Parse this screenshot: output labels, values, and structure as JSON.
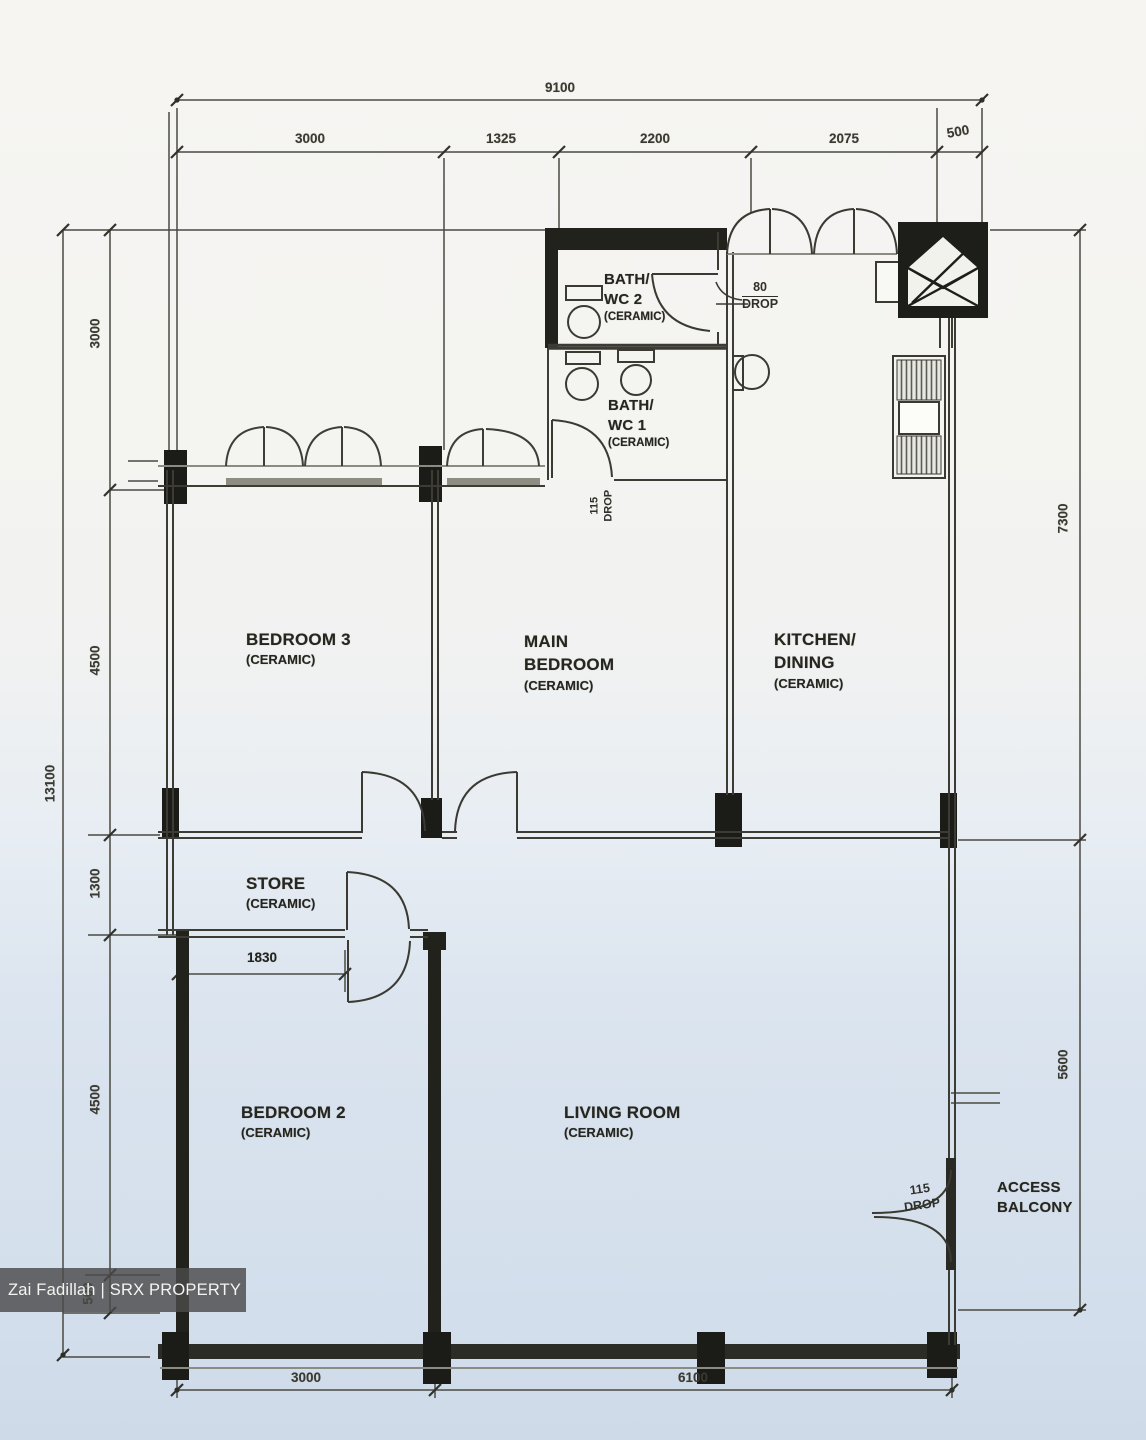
{
  "watermark": {
    "text": "Zai Fadillah | SRX PROPERTY"
  },
  "rooms": {
    "bedroom3": {
      "name": "BEDROOM 3",
      "finish": "(CERAMIC)"
    },
    "main_bedroom": {
      "line1": "MAIN",
      "line2": "BEDROOM",
      "finish": "(CERAMIC)"
    },
    "kitchen": {
      "line1": "KITCHEN/",
      "line2": "DINING",
      "finish": "(CERAMIC)"
    },
    "bath_wc2": {
      "line1": "BATH/",
      "line2": "WC 2",
      "finish": "(CERAMIC)"
    },
    "bath_wc1": {
      "line1": "BATH/",
      "line2": "WC 1",
      "finish": "(CERAMIC)"
    },
    "store": {
      "name": "STORE",
      "finish": "(CERAMIC)"
    },
    "bedroom2": {
      "name": "BEDROOM 2",
      "finish": "(CERAMIC)"
    },
    "living": {
      "name": "LIVING ROOM",
      "finish": "(CERAMIC)"
    },
    "access_balcony": {
      "line1": "ACCESS",
      "line2": "BALCONY"
    }
  },
  "drops": {
    "kitchen_entry": {
      "value": "80",
      "label": "DROP"
    },
    "bath1": {
      "value": "115",
      "label": "DROP"
    },
    "balcony": {
      "value": "115",
      "label": "DROP"
    }
  },
  "dimensions": {
    "top": {
      "total": "9100",
      "seg1": "3000",
      "seg2": "1325",
      "seg3": "2200",
      "seg4": "2075",
      "seg5": "500"
    },
    "left": {
      "total": "13100",
      "seg1": "3000",
      "seg2": "4500",
      "seg3": "1300",
      "seg4": "4500",
      "seg5": "500"
    },
    "right": {
      "seg1": "7300",
      "seg2": "5600"
    },
    "bottom": {
      "seg1": "3000",
      "seg2": "6100"
    },
    "store_width": "1830"
  },
  "icons": {
    "refuse_chute": "refuse-chute-icon"
  },
  "colors": {
    "line": "#3c3c35",
    "wall": "#20201c",
    "watermark_bg": "#4a4a4a",
    "background_top": "#f6f5f2",
    "background_bottom": "#cedae8"
  }
}
